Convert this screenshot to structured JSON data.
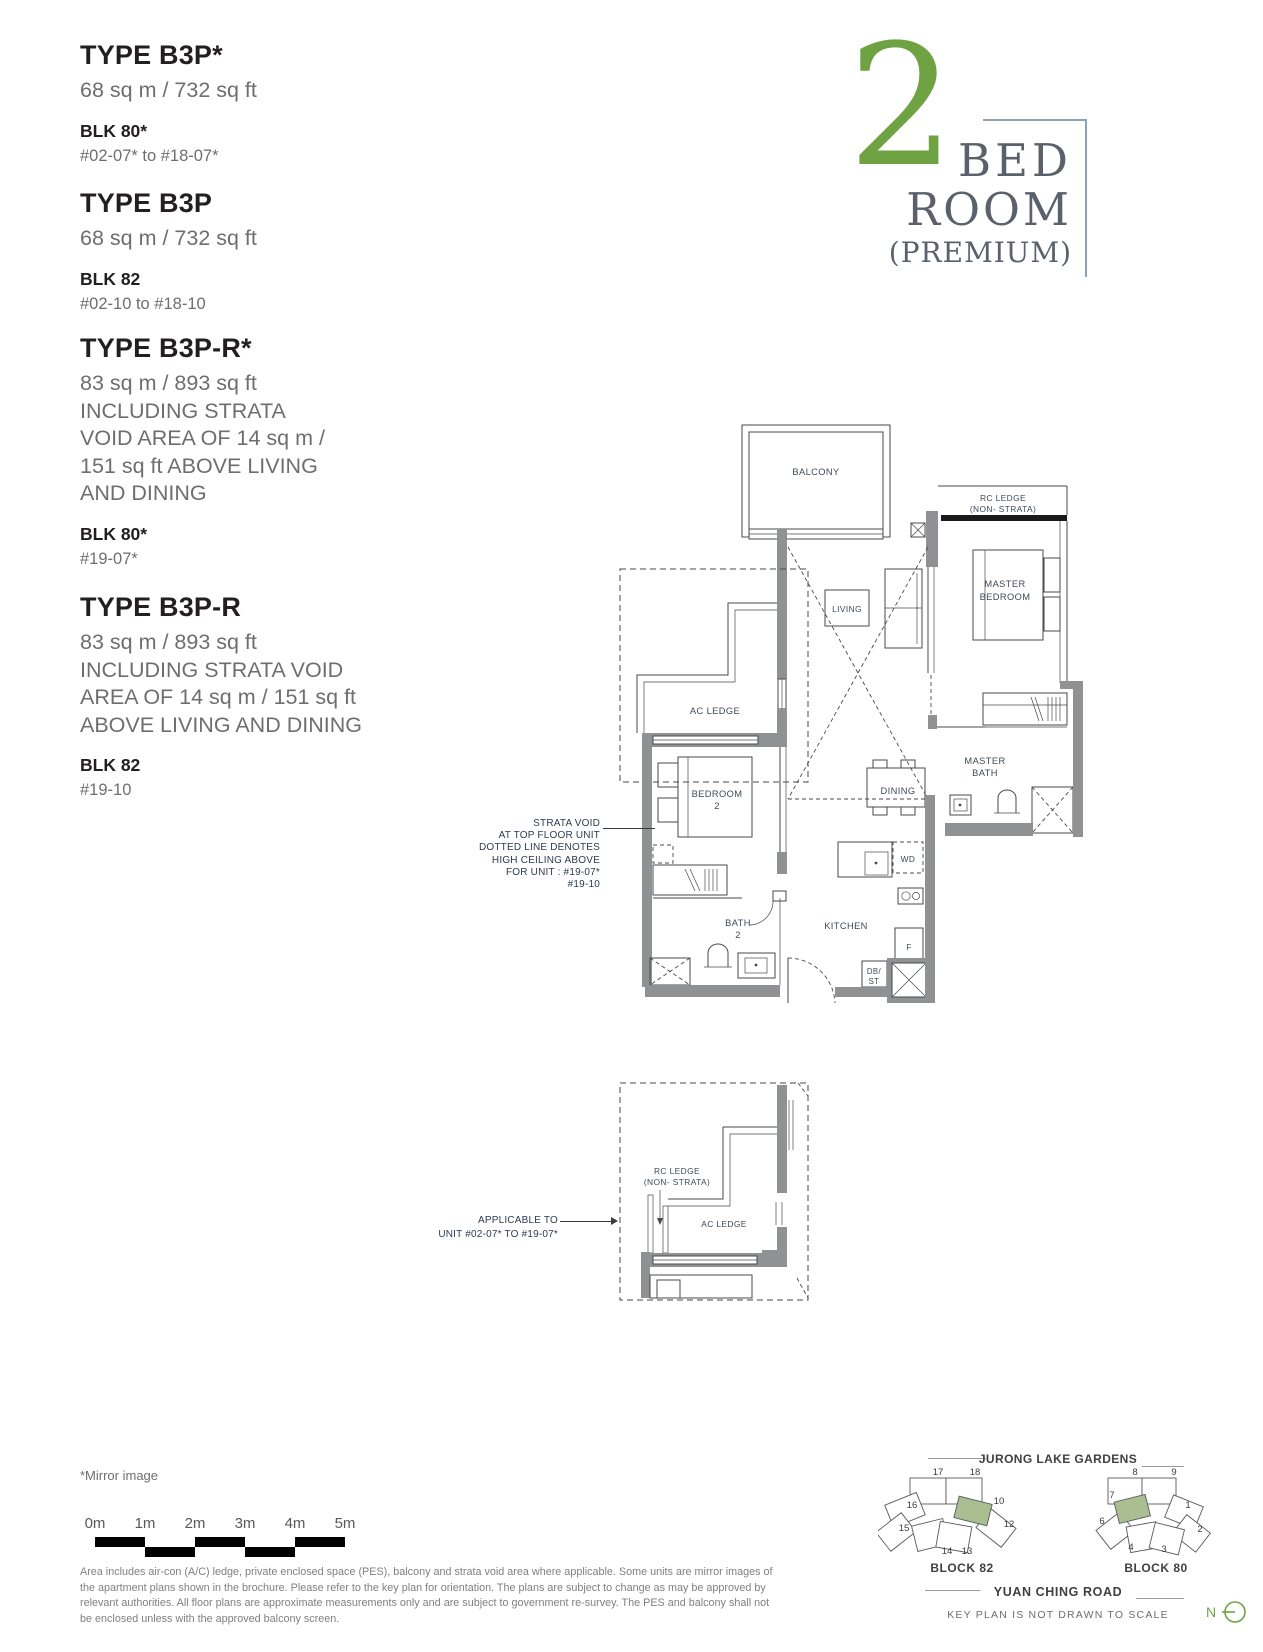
{
  "colors": {
    "accent_green": "#6FA243",
    "keyplan_highlight": "#A9BF92",
    "wall_gray": "#8F9193"
  },
  "logo": {
    "number": "2",
    "bed": "BED",
    "room": "ROOM",
    "premium": "(PREMIUM)"
  },
  "unit_types": [
    {
      "title": "TYPE B3P*",
      "area_lines": [
        "68 sq m / 732 sq ft"
      ],
      "blk": "BLK 80*",
      "units": "#02-07* to #18-07*"
    },
    {
      "title": "TYPE B3P",
      "area_lines": [
        "68 sq m / 732 sq ft"
      ],
      "blk": "BLK 82",
      "units": "#02-10 to #18-10"
    },
    {
      "title": "TYPE B3P-R*",
      "area_lines": [
        "83 sq m / 893 sq ft",
        "INCLUDING STRATA",
        "VOID AREA OF 14 sq m /",
        "151 sq ft ABOVE LIVING",
        "AND DINING"
      ],
      "blk": "BLK 80*",
      "units": "#19-07*"
    },
    {
      "title": "TYPE B3P-R",
      "area_lines": [
        "83 sq m / 893 sq ft",
        "INCLUDING STRATA VOID",
        "AREA OF 14 sq m / 151 sq ft",
        "ABOVE LIVING AND DINING"
      ],
      "blk": "BLK 82",
      "units": "#19-10"
    }
  ],
  "plan": {
    "balcony": "BALCONY",
    "rc_ledge_line1": "RC LEDGE",
    "rc_ledge_line2": "(NON- STRATA)",
    "master_bedroom_line1": "MASTER",
    "master_bedroom_line2": "BEDROOM",
    "living": "LIVING",
    "ac_ledge": "AC LEDGE",
    "bedroom2_line1": "BEDROOM",
    "bedroom2_line2": "2",
    "dining": "DINING",
    "master_bath_line1": "MASTER",
    "master_bath_line2": "BATH",
    "wd": "WD",
    "kitchen": "KITCHEN",
    "fridge": "F",
    "db_line1": "DB/",
    "db_line2": "ST",
    "bath2_line1": "BATH",
    "bath2_line2": "2"
  },
  "annotations": {
    "strata_void_lines": [
      "STRATA VOID",
      "AT TOP FLOOR UNIT",
      "DOTTED LINE DENOTES",
      "HIGH CEILING ABOVE",
      "FOR UNIT : #19-07*",
      "#19-10"
    ],
    "applicable_lines": [
      "APPLICABLE TO",
      "UNIT #02-07* TO #19-07*"
    ]
  },
  "lower_plan": {
    "rc_ledge_line1": "RC LEDGE",
    "rc_ledge_line2": "(NON- STRATA)",
    "ac_ledge": "AC LEDGE"
  },
  "footer": {
    "mirror_note": "*Mirror image",
    "scale_labels": [
      "0m",
      "1m",
      "2m",
      "3m",
      "4m",
      "5m"
    ],
    "disclaimer": "Area includes air-con (A/C) ledge, private enclosed space (PES), balcony and strata void area where applicable. Some units are mirror images of the apartment plans shown in the brochure. Please refer to the key plan for orientation. The plans are subject to change as may be approved by relevant authorities. All floor plans are approximate measurements only and are subject to government re-survey. The PES and balcony shall not be enclosed unless with the approved balcony screen."
  },
  "key_plan": {
    "top_label": "JURONG LAKE GARDENS",
    "road_label": "YUAN CHING ROAD",
    "note": "KEY PLAN IS NOT DRAWN TO SCALE",
    "north_label": "N",
    "block82": {
      "label": "BLOCK 82",
      "unit_numbers": [
        "17",
        "18",
        "16",
        "10",
        "15",
        "12",
        "14",
        "13"
      ],
      "highlighted": "10"
    },
    "block80": {
      "label": "BLOCK 80",
      "unit_numbers": [
        "8",
        "9",
        "7",
        "1",
        "6",
        "2",
        "4",
        "3"
      ],
      "highlighted": "7"
    }
  }
}
